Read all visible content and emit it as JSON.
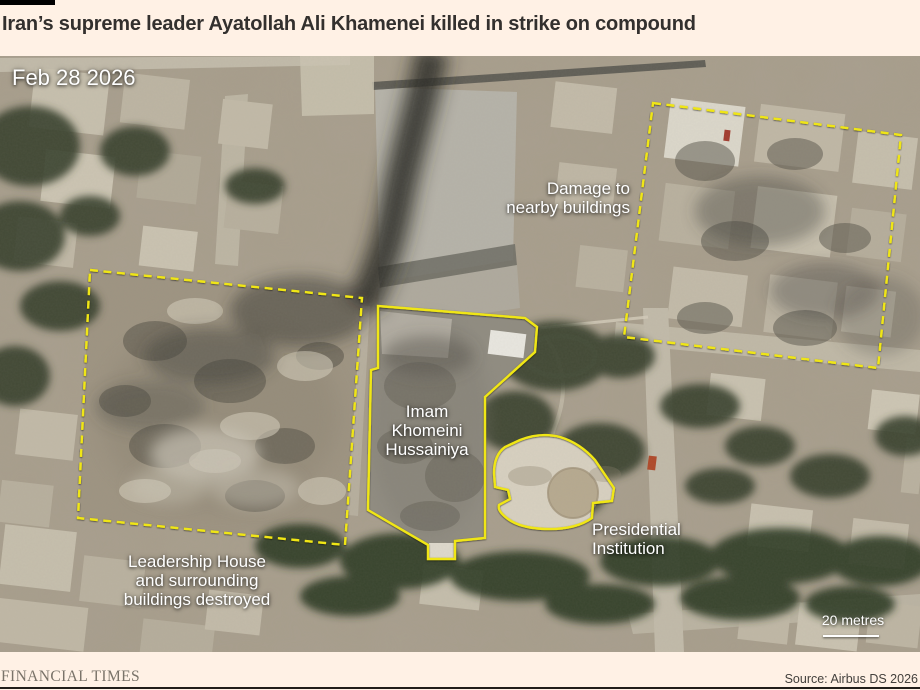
{
  "header": {
    "headline": "Iran’s supreme leader Ayatollah Ali Khamenei killed in strike on compound"
  },
  "map": {
    "date_label": "Feb 28 2026",
    "labels": {
      "damage": "Damage to\nnearby buildings",
      "hussainiya": "Imam\nKhomeini\nHussainiya",
      "presidential": "Presidential\nInstitution",
      "leadership": "Leadership House\nand surrounding\nbuildings destroyed"
    },
    "scale_label": "20 metres"
  },
  "footer": {
    "brand": "FINANCIAL TIMES",
    "source": "Source: Airbus DS 2026"
  },
  "colors": {
    "background": "#FFF1E5",
    "annotation_yellow": "#F0E612",
    "headline_text": "#33302E"
  }
}
